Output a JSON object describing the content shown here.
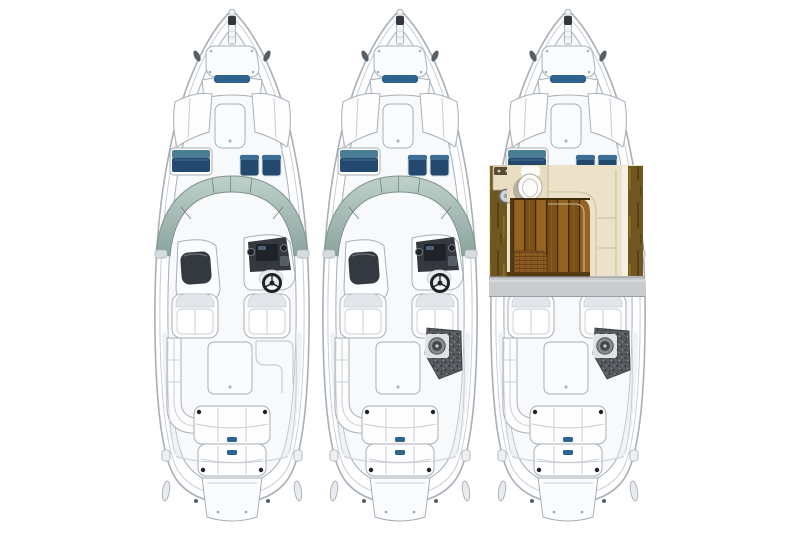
{
  "page": {
    "background": "#ffffff",
    "description": "Three top-down deck-plan illustrations of the same bowrider boat: standard deck plan, deck plan with aft storage pad, and deck plan with mid-cabin cutaway revealing head and wood cabin sole"
  },
  "palette": {
    "line_gray": "#a7afb7",
    "line_light": "#c9ced4",
    "deck_fill": "#f7f9fa",
    "hull_white": "#ffffff",
    "windshield_top": "#bed0cb",
    "windshield_bottom": "#8ba49e",
    "windshield_edge": "#7f938e",
    "navy": "#24496e",
    "navy_light": "#3c6e96",
    "teal": "#4b7d94",
    "accent_blue": "#2e6390",
    "dash_dark": "#34393f",
    "dash_mid": "#575e66",
    "gauge_dark": "#1f2327",
    "speckle_base": "#56595e",
    "speckle_dark": "#2b2e33",
    "speckle_light": "#878c92",
    "wood_panel": "#6f571f",
    "wood_streak": "#55421a",
    "wood_streak_light": "#8a6f2e",
    "plank_a": "#7c4f16",
    "plank_b": "#96621f",
    "plank_seam": "#402b09",
    "cream": "#ece2c9",
    "cream_line": "#c6b996",
    "head_floor": "#e8ddc1",
    "wicker": "#8a5c24",
    "wicker_line": "#6b4416",
    "gray_band": "#c9cbcd",
    "gray_band_line": "#979da3",
    "toilet_shadow": "#b5af9f",
    "shade": "#e9edf1"
  },
  "boats": [
    {
      "id": "boat-standard",
      "variant": "standard-deck-plan",
      "features": [
        "bow-anchor-locker",
        "bow-lounge",
        "wraparound-windshield",
        "port-console",
        "helm-console",
        "twin-bucket-seats",
        "port-l-lounge",
        "starboard-step",
        "aft-sun-pad",
        "swim-platform"
      ]
    },
    {
      "id": "boat-aft-pad",
      "variant": "deck-plan-with-aft-storage-pad",
      "features": [
        "bow-anchor-locker",
        "bow-lounge",
        "wraparound-windshield",
        "port-console",
        "helm-console",
        "twin-bucket-seats",
        "port-l-lounge",
        "aft-storage-pad",
        "aft-sun-pad",
        "swim-platform"
      ]
    },
    {
      "id": "boat-cabin-cutaway",
      "variant": "deck-plan-with-cabin-cutaway",
      "features": [
        "bow-anchor-locker",
        "bow-lounge",
        "cabin-cutaway",
        "head-compartment",
        "toilet",
        "vanity-sink",
        "wood-cabin-sole",
        "cabin-lounge",
        "wicker-cushion",
        "section-band",
        "twin-bucket-seats",
        "port-l-lounge",
        "aft-storage-pad",
        "aft-sun-pad",
        "swim-platform"
      ]
    }
  ]
}
